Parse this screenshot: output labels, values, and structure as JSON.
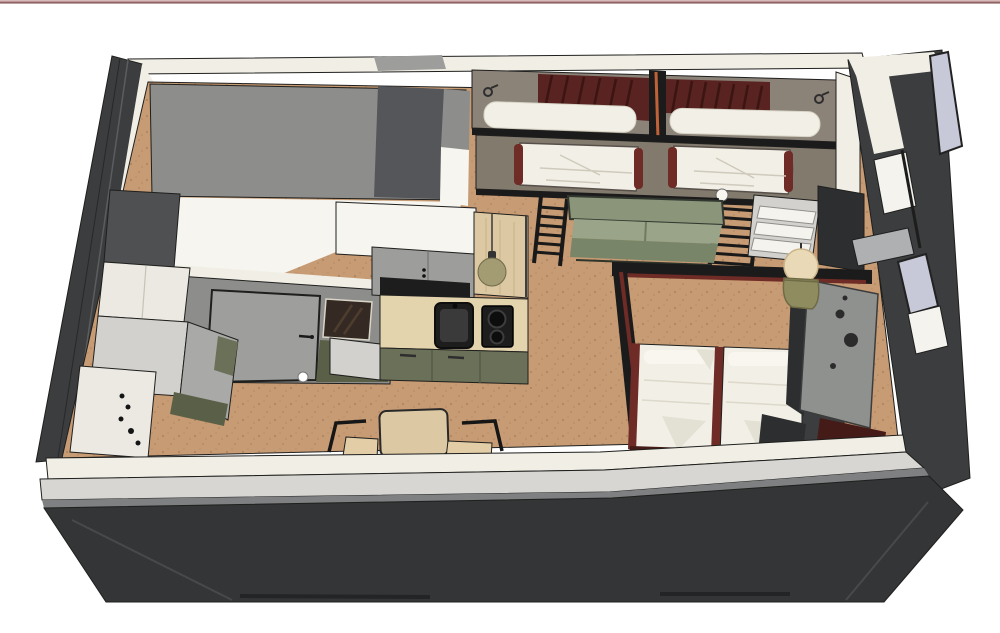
{
  "scene": {
    "type": "3d-cutaway-apartment-floorplan-render",
    "rooms": [
      "bathroom",
      "kitchen",
      "living-area",
      "bunk-bed-alcove",
      "bedroom-nook"
    ],
    "objects": [
      "double-bunk-capsule-beds",
      "sofa",
      "double-bed",
      "dining-table",
      "dining-chairs",
      "kitchen-counter",
      "sink",
      "cooktop",
      "storage-steps",
      "bunk-ladders",
      "pendant-lamp-small",
      "pendant-lamp-large",
      "entrance-door",
      "mirror",
      "washer-cabinets",
      "pegboard-panel",
      "windows"
    ]
  },
  "palette": {
    "white": "#ffffff",
    "topline_light": "#d8baba",
    "topline_dark": "#916464",
    "ext_wall": "#3b3d3e",
    "ext_wall_dark": "#333536",
    "cut_white": "#f1efe5",
    "band_gray": "#d7d6d2",
    "band_gray_dark": "#7e8082",
    "int_wall_gray": "#8d8d8b",
    "int_wall_dark": "#54565a",
    "room_white": "#f6f5f0",
    "floor": "#c79b73",
    "cab_white": "#ebe9e1",
    "cab_gray_light": "#d2d1cd",
    "cab_gray_mid": "#a9a9a7",
    "cab_gray": "#9d9d9b",
    "cab_dark_gray": "#4e5052",
    "door_gray": "#9e9e9c",
    "mirror_dark": "#342a23",
    "olive": "#6b7158",
    "olive_dark": "#5a6047",
    "wood": "#dcc8a2",
    "wood_light": "#e4d4ae",
    "appliance_black": "#1d1d1d",
    "appliance_black2": "#3a3a3a",
    "taupe": "#8b8278",
    "taupe_dark": "#837a6e",
    "maroon": "#582320",
    "maroon_bright": "#6f2b25",
    "maroon_deep": "#451b17",
    "bedding": "#f2efe7",
    "bedding_shadow": "#e3e0d4",
    "pillow_white": "#f8f6ef",
    "rail_black": "#1b1b1b",
    "sofa": "#8a957a",
    "sofa_light": "#99a488",
    "sofa_dark": "#798569",
    "lamp_olive": "#a39c72",
    "lamp_cream": "#ead9b6",
    "lamp_pot": "#8f8c60",
    "lavender": "#c7c9d9",
    "frame_white": "#f4f3ee",
    "panel_gray": "#8f918f",
    "post_dark": "#2c2e2f",
    "accent_orange": "#c06238",
    "chair_wood": "#e2cda6",
    "sill_gray": "#aeb0b2"
  }
}
